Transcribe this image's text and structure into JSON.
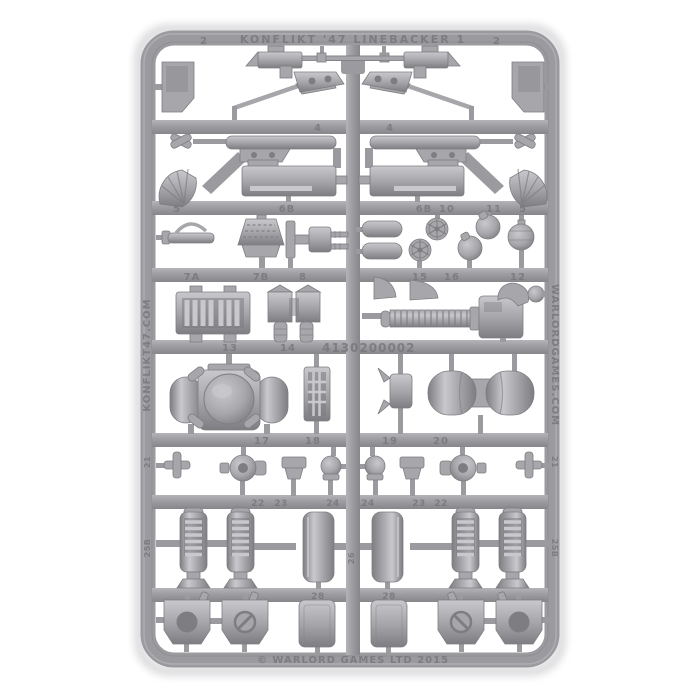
{
  "sprue": {
    "top_rail_text": "KONFLIKT '47 LINEBACKER 1",
    "left_rail_text": "KONFLIKT47.COM",
    "right_rail_text": "WARLORDGAMES.COM",
    "bottom_rail_text": "© WARLORD GAMES LTD 2015",
    "mold_code": "4130200002",
    "part_labels": {
      "n2": "2",
      "n4": "4",
      "n5": "5",
      "n6b": "6B",
      "n7a": "7A",
      "n7b": "7B",
      "n8": "8",
      "n10": "10",
      "n11": "11",
      "n12": "12",
      "n13": "13",
      "n14": "14",
      "n15": "15",
      "n16": "16",
      "n17": "17",
      "n18": "18",
      "n19": "19",
      "n20": "20",
      "n21": "21",
      "n22": "22",
      "n23": "23",
      "n24": "24",
      "n25b": "25B",
      "n26": "26",
      "n28": "28"
    }
  },
  "colors": {
    "background": "#ffffff",
    "rail": "#9b9b9f",
    "rail_light": "#b4b4b8",
    "rail_dark": "#87878b",
    "part_base": "#a7a7ab",
    "part_highlight": "#c9c9cd",
    "part_shadow": "#7e7e82",
    "molded_text": "#77777c",
    "shadow_soft": "#dcdcde"
  }
}
